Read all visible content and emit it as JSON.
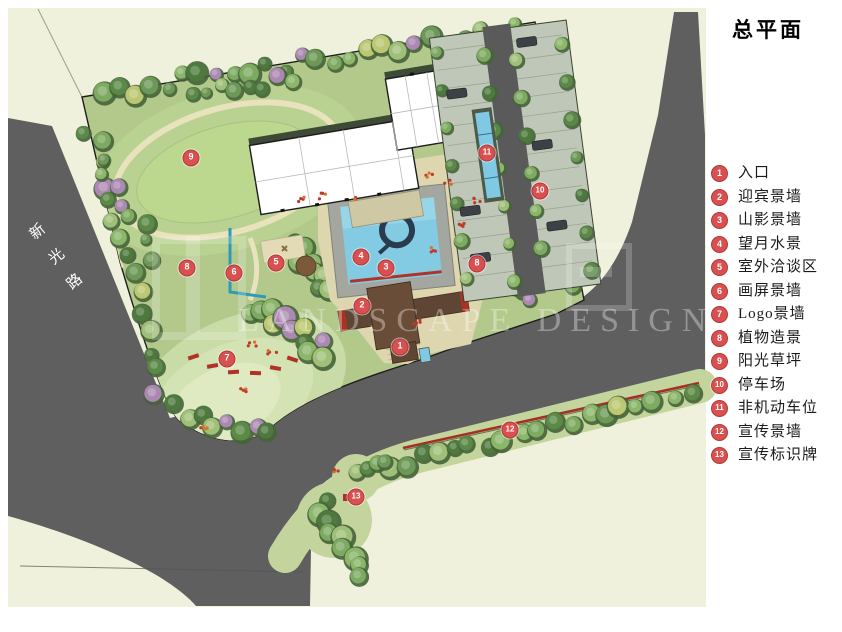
{
  "title": "总平面",
  "road_label": {
    "name": "新光路",
    "chars": [
      "新",
      "光",
      "路"
    ]
  },
  "watermark": "LANDSCAPE DESIGN",
  "legend": {
    "items": [
      {
        "num": "1",
        "label": "入口"
      },
      {
        "num": "2",
        "label": "迎宾景墙"
      },
      {
        "num": "3",
        "label": "山影景墙"
      },
      {
        "num": "4",
        "label": "望月水景"
      },
      {
        "num": "5",
        "label": "室外洽谈区"
      },
      {
        "num": "6",
        "label": "画屏景墙"
      },
      {
        "num": "7",
        "label": "Logo景墙"
      },
      {
        "num": "8",
        "label": "植物造景"
      },
      {
        "num": "9",
        "label": "阳光草坪"
      },
      {
        "num": "10",
        "label": "停车场"
      },
      {
        "num": "11",
        "label": "非机动车位"
      },
      {
        "num": "12",
        "label": "宣传景墙"
      },
      {
        "num": "13",
        "label": "宣传标识牌"
      }
    ]
  },
  "plan_markers": [
    {
      "num": "1",
      "x": 400,
      "y": 347
    },
    {
      "num": "2",
      "x": 362,
      "y": 306
    },
    {
      "num": "3",
      "x": 386,
      "y": 268
    },
    {
      "num": "4",
      "x": 361,
      "y": 257
    },
    {
      "num": "5",
      "x": 276,
      "y": 263
    },
    {
      "num": "6",
      "x": 234,
      "y": 273
    },
    {
      "num": "7",
      "x": 227,
      "y": 359
    },
    {
      "num": "8",
      "x": 187,
      "y": 268
    },
    {
      "num": "8",
      "x": 477,
      "y": 264
    },
    {
      "num": "9",
      "x": 191,
      "y": 158
    },
    {
      "num": "10",
      "x": 540,
      "y": 191
    },
    {
      "num": "11",
      "x": 487,
      "y": 153
    },
    {
      "num": "12",
      "x": 510,
      "y": 430
    },
    {
      "num": "13",
      "x": 356,
      "y": 497
    }
  ],
  "colors": {
    "canvas": "#f0f1dd",
    "road": "#5f5f5f",
    "site_green": "#b3c98c",
    "verge_green": "#c4d49d",
    "water": "#7fc9e4",
    "wall_brown": "#5d4533",
    "accent_red": "#a93226",
    "marker_red": "#d8504f"
  }
}
